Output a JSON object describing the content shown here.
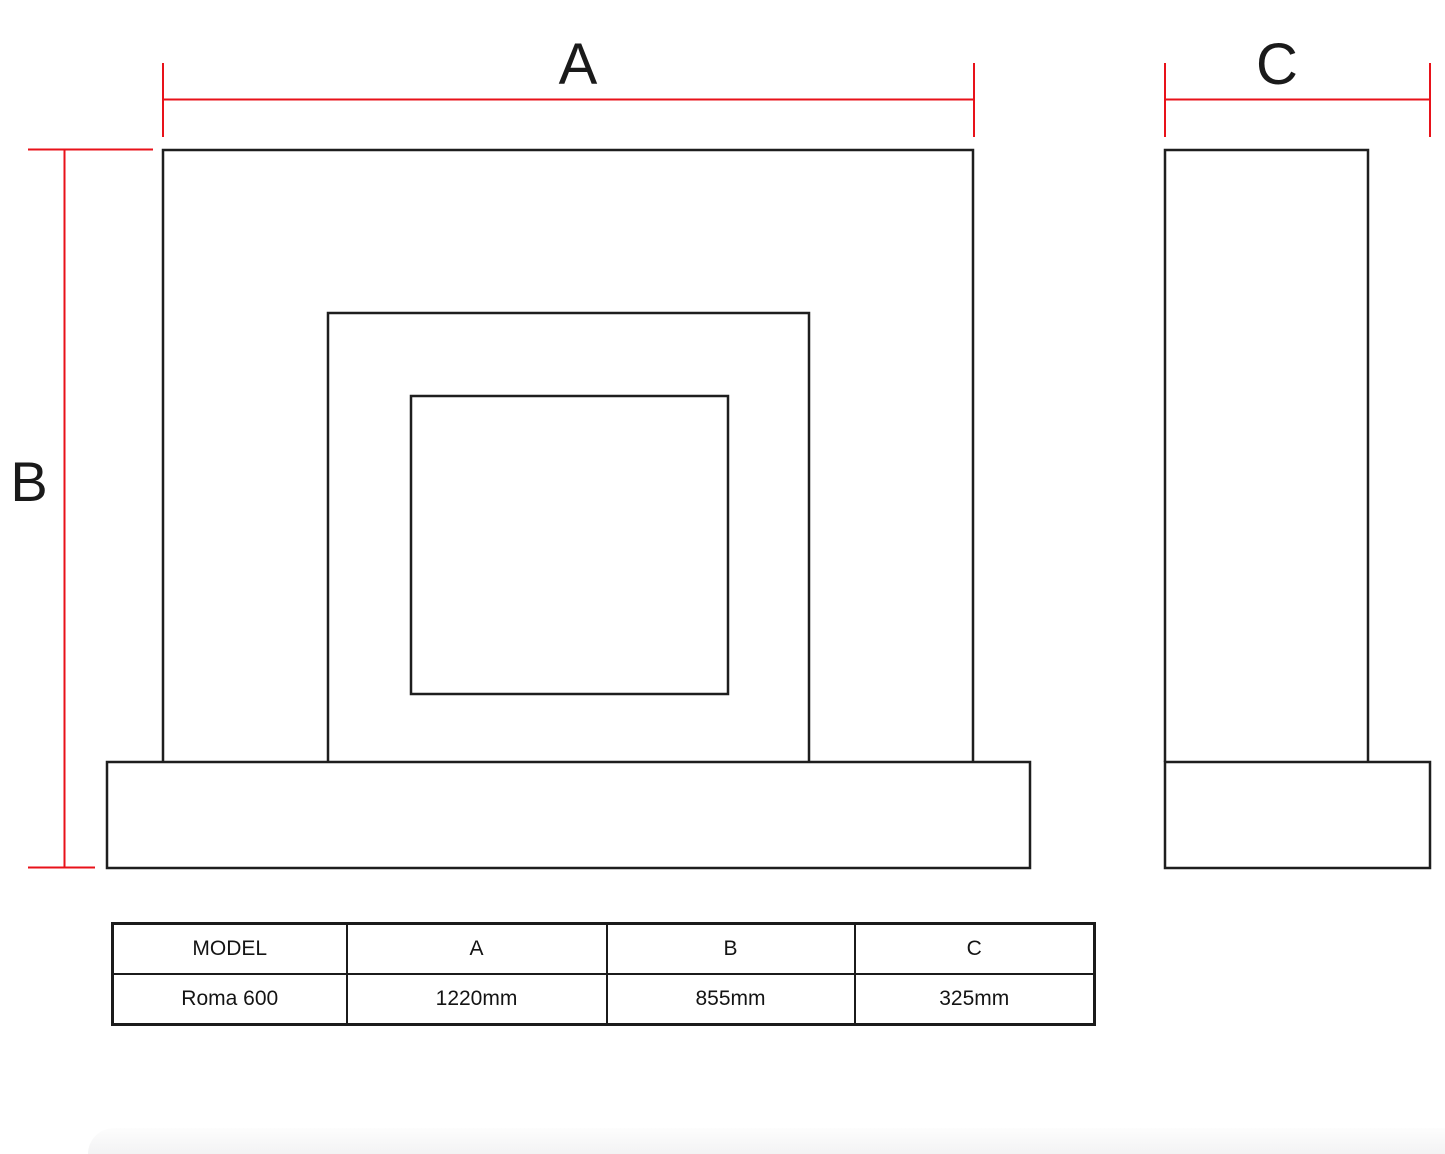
{
  "colors": {
    "dimension_red": "#e8121a",
    "line_black": "#1e1e1e"
  },
  "dimensions": {
    "a_label": "A",
    "b_label": "B",
    "c_label": "C"
  },
  "table": {
    "headers": [
      "MODEL",
      "A",
      "B",
      "C"
    ],
    "rows": [
      [
        "Roma 600",
        "1220mm",
        "855mm",
        "325mm"
      ]
    ]
  }
}
